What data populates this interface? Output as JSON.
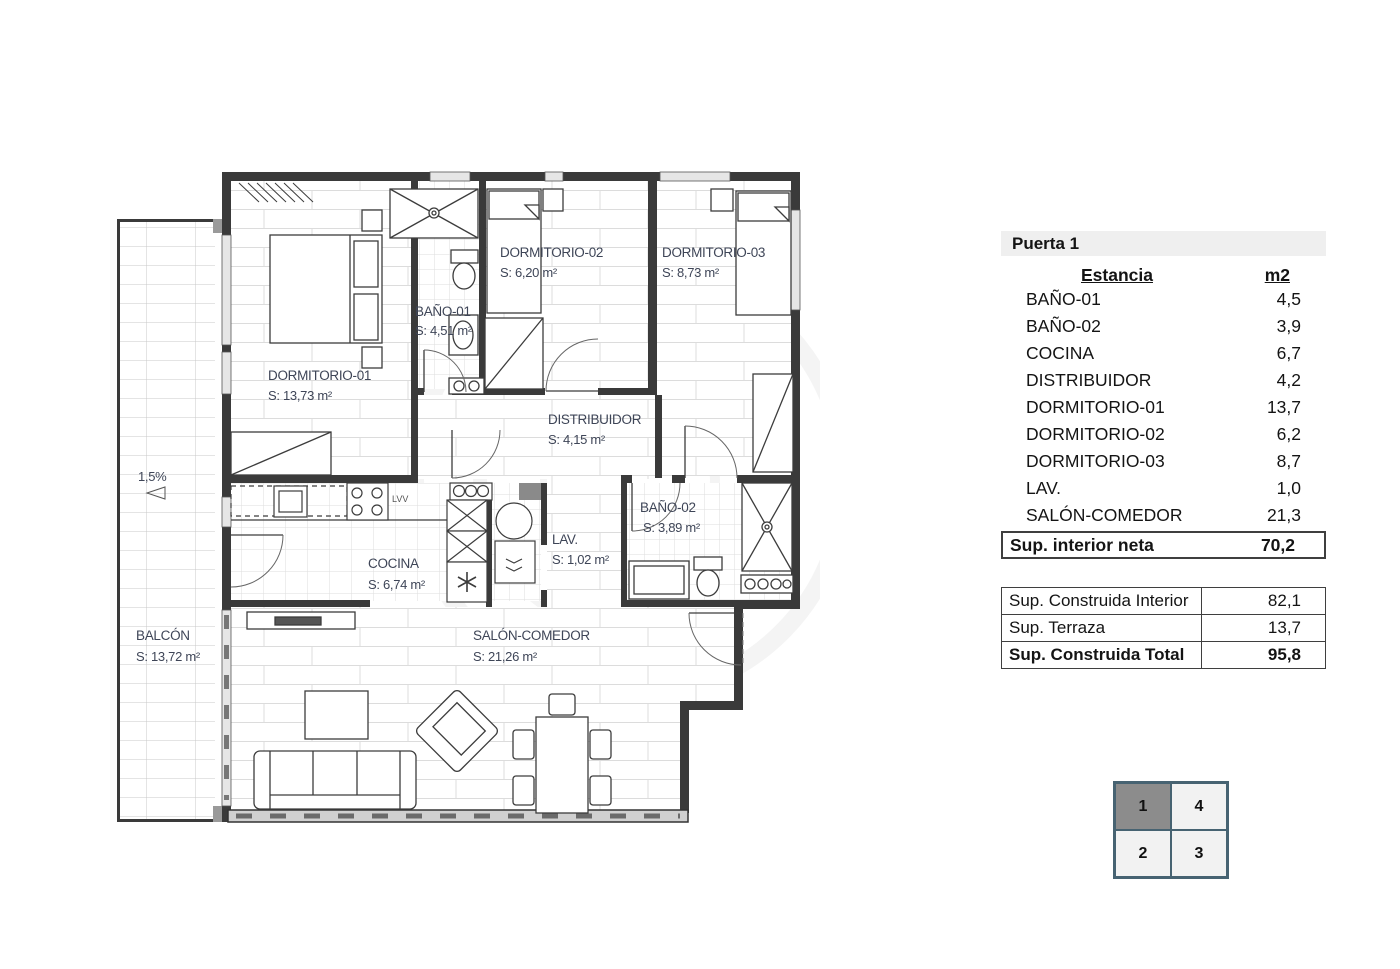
{
  "plan": {
    "rooms": [
      {
        "name": "DORMITORIO-01",
        "area": "S: 13,73 m²"
      },
      {
        "name": "DORMITORIO-02",
        "area": "S: 6,20 m²"
      },
      {
        "name": "DORMITORIO-03",
        "area": "S: 8,73 m²"
      },
      {
        "name": "BAÑO-01",
        "area": "S: 4,51 m²"
      },
      {
        "name": "BAÑO-02",
        "area": "S: 3,89 m²"
      },
      {
        "name": "DISTRIBUIDOR",
        "area": "S: 4,15 m²"
      },
      {
        "name": "COCINA",
        "area": "S: 6,74 m²"
      },
      {
        "name": "LAV.",
        "area": "S: 1,02 m²"
      },
      {
        "name": "SALÓN-COMEDOR",
        "area": "S: 21,26 m²"
      },
      {
        "name": "BALCÓN",
        "area": "S: 13,72 m²"
      }
    ],
    "slope_label": "1,5%",
    "dishwasher_label": "LVV"
  },
  "panel": {
    "title": "Puerta 1",
    "columns": {
      "room": "Estancia",
      "area": "m2"
    },
    "rows": [
      {
        "label": "BAÑO-01",
        "value": "4,5"
      },
      {
        "label": "BAÑO-02",
        "value": "3,9"
      },
      {
        "label": "COCINA",
        "value": "6,7"
      },
      {
        "label": "DISTRIBUIDOR",
        "value": "4,2"
      },
      {
        "label": "DORMITORIO-01",
        "value": "13,7"
      },
      {
        "label": "DORMITORIO-02",
        "value": "6,2"
      },
      {
        "label": "DORMITORIO-03",
        "value": "8,7"
      },
      {
        "label": "LAV.",
        "value": "1,0"
      },
      {
        "label": "SALÓN-COMEDOR",
        "value": "21,3"
      }
    ],
    "net_total": {
      "label": "Sup. interior neta",
      "value": "70,2"
    },
    "summary": [
      {
        "label": "Sup. Construida Interior",
        "value": "82,1"
      },
      {
        "label": "Sup. Terraza",
        "value": "13,7"
      },
      {
        "label": "Sup. Construida Total",
        "value": "95,8"
      }
    ]
  },
  "unit_grid": {
    "cells": [
      {
        "label": "1"
      },
      {
        "label": "4"
      },
      {
        "label": "2"
      },
      {
        "label": "3"
      }
    ]
  },
  "colors": {
    "wall": "#3a3a3a",
    "label_text": "#3e4557",
    "grid_border": "#476372",
    "active_cell": "#8c8c8c"
  }
}
